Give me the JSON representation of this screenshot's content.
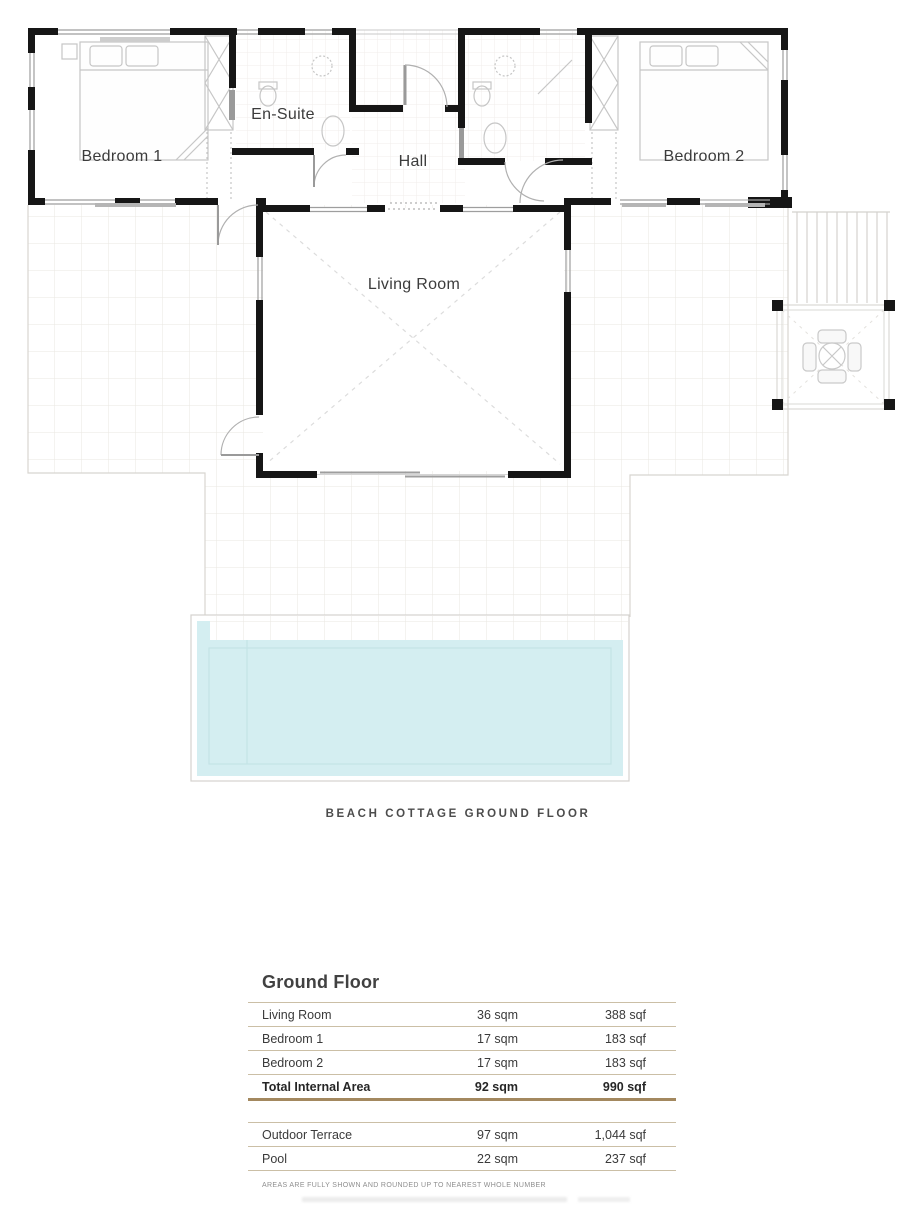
{
  "plan": {
    "labels": {
      "bedroom1": "Bedroom 1",
      "ensuite": "En-Suite",
      "hall": "Hall",
      "bedroom2": "Bedroom 2",
      "living": "Living Room"
    },
    "caption": "BEACH COTTAGE GROUND FLOOR"
  },
  "area_table": {
    "title": "Ground Floor",
    "internal_rows": [
      {
        "name": "Living Room",
        "sqm": "36 sqm",
        "sqf": "388 sqf"
      },
      {
        "name": "Bedroom 1",
        "sqm": "17 sqm",
        "sqf": "183 sqf"
      },
      {
        "name": "Bedroom 2",
        "sqm": "17 sqm",
        "sqf": "183 sqf"
      }
    ],
    "total_row": {
      "name": "Total Internal Area",
      "sqm": "92 sqm",
      "sqf": "990 sqf"
    },
    "outdoor_rows": [
      {
        "name": "Outdoor Terrace",
        "sqm": "97 sqm",
        "sqf": "1,044 sqf"
      },
      {
        "name": "Pool",
        "sqm": "22 sqm",
        "sqf": "237 sqf"
      }
    ],
    "footnote": "AREAS ARE FULLY SHOWN AND ROUNDED UP TO NEAREST WHOLE NUMBER"
  },
  "colors": {
    "wall": "#161616",
    "pool_water": "#d4eef1",
    "table_line": "#cbbfa6",
    "table_line_strong": "#a3885f",
    "grid_line": "#eae7e2"
  }
}
